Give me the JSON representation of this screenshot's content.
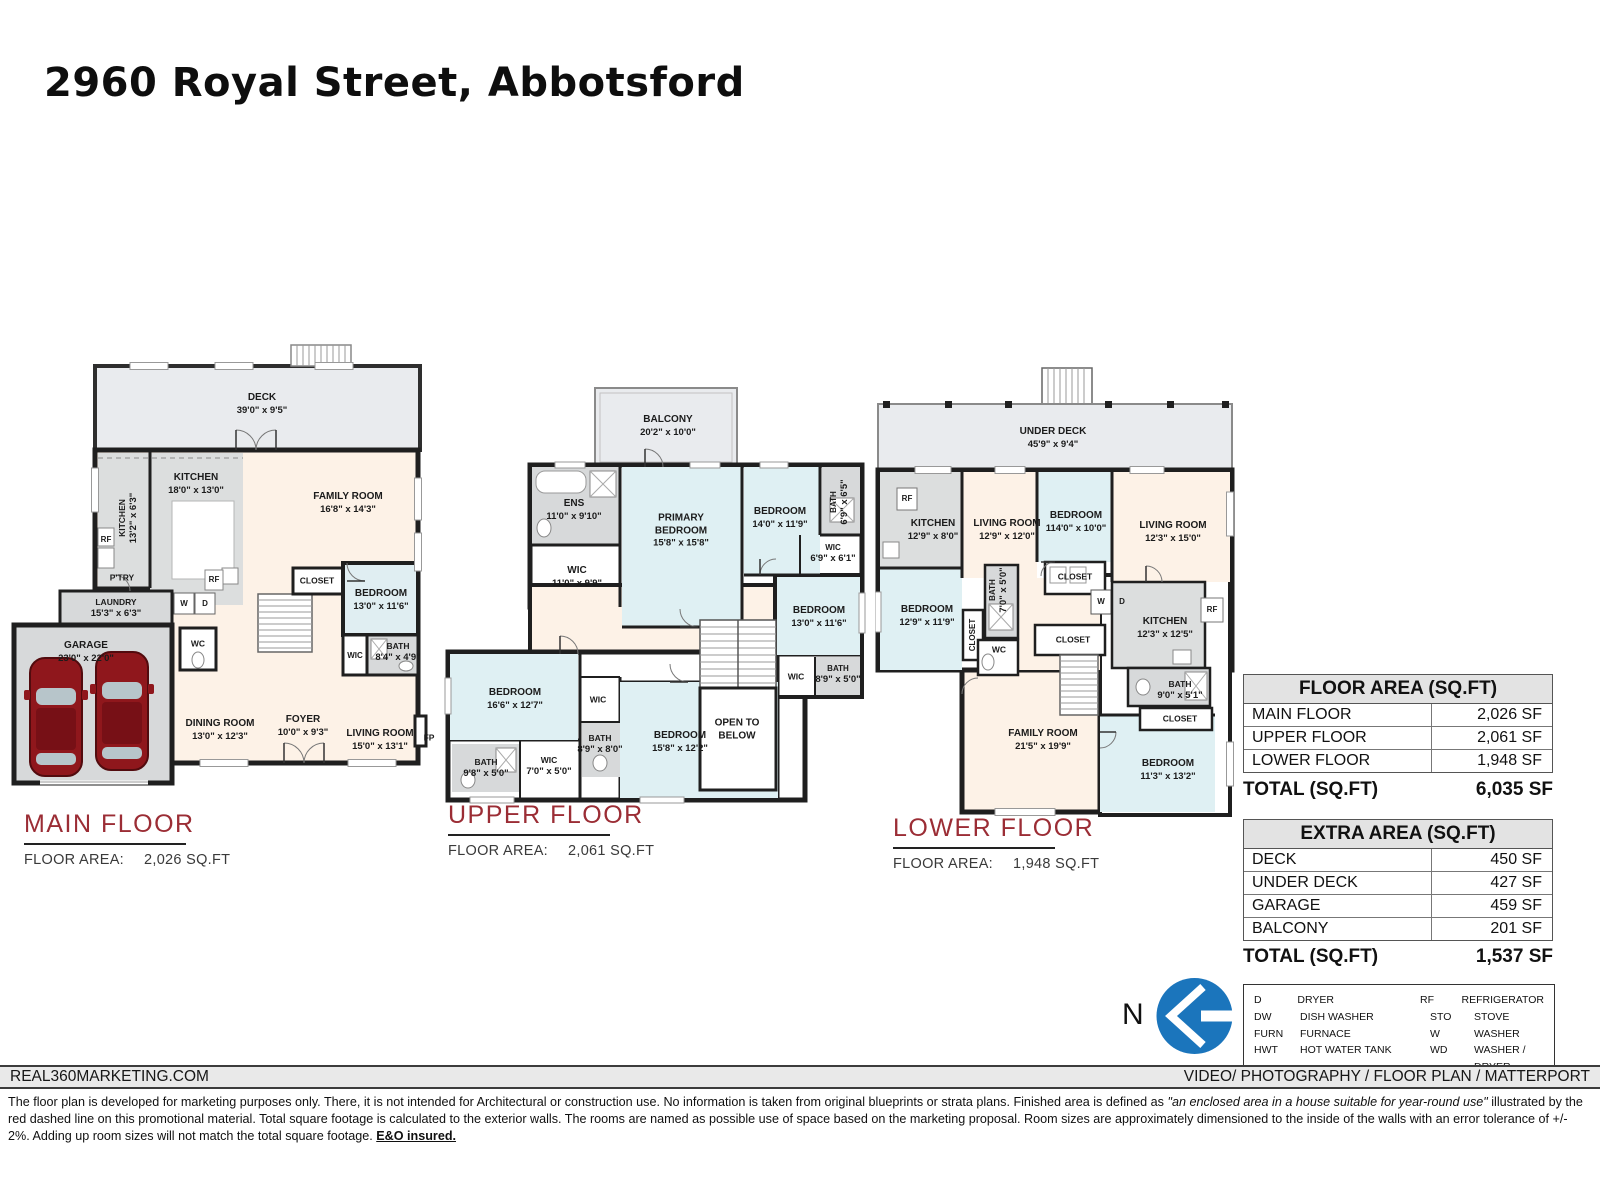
{
  "page": {
    "title": "2960 Royal Street, Abbotsford"
  },
  "floors": {
    "main": {
      "name": "MAIN FLOOR",
      "area_label": "FLOOR AREA:",
      "area_value": "2,026 SQ.FT",
      "labels": [
        {
          "name": "DECK",
          "dims": "39'0\" x 9'5\""
        },
        {
          "name": "KITCHEN",
          "dims": "18'0\" x 13'0\""
        },
        {
          "name": "KITCHEN",
          "dims": "13'2\" x 6'3\""
        },
        {
          "name": "RF",
          "dims": ""
        },
        {
          "name": "P'TRY",
          "dims": ""
        },
        {
          "name": "FAMILY ROOM",
          "dims": "16'8\" x 14'3\""
        },
        {
          "name": "RF",
          "dims": ""
        },
        {
          "name": "LAUNDRY",
          "dims": "15'3\" x 6'3\""
        },
        {
          "name": "W",
          "dims": ""
        },
        {
          "name": "D",
          "dims": ""
        },
        {
          "name": "GARAGE",
          "dims": "23'0\" x 22'0\""
        },
        {
          "name": "WC",
          "dims": ""
        },
        {
          "name": "CLOSET",
          "dims": ""
        },
        {
          "name": "BEDROOM",
          "dims": "13'0\" x 11'6\""
        },
        {
          "name": "WIC",
          "dims": ""
        },
        {
          "name": "BATH",
          "dims": "8'4\" x 4'9\""
        },
        {
          "name": "DINING ROOM",
          "dims": "13'0\" x 12'3\""
        },
        {
          "name": "FOYER",
          "dims": "10'0\" x 9'3\""
        },
        {
          "name": "LIVING ROOM",
          "dims": "15'0\" x 13'1\""
        },
        {
          "name": "FP",
          "dims": ""
        }
      ]
    },
    "upper": {
      "name": "UPPER FLOOR",
      "area_label": "FLOOR AREA:",
      "area_value": "2,061 SQ.FT",
      "labels": [
        {
          "name": "BALCONY",
          "dims": "20'2\" x 10'0\""
        },
        {
          "name": "ENS",
          "dims": "11'0\" x 9'10\""
        },
        {
          "name": "PRIMARY BEDROOM",
          "dims": "15'8\" x 15'8\""
        },
        {
          "name": "BEDROOM",
          "dims": "14'0\" x 11'9\""
        },
        {
          "name": "BATH",
          "dims": "6'9\" x 6'5\""
        },
        {
          "name": "WIC",
          "dims": "6'9\" x 6'1\""
        },
        {
          "name": "WIC",
          "dims": "11'0\" x 9'9\""
        },
        {
          "name": "BEDROOM",
          "dims": "13'0\" x 11'6\""
        },
        {
          "name": "BEDROOM",
          "dims": "16'6\" x 12'7\""
        },
        {
          "name": "WIC",
          "dims": ""
        },
        {
          "name": "BATH",
          "dims": "8'9\" x 8'0\""
        },
        {
          "name": "BEDROOM",
          "dims": "15'8\" x 12'2\""
        },
        {
          "name": "OPEN TO BELOW",
          "dims": ""
        },
        {
          "name": "WIC",
          "dims": ""
        },
        {
          "name": "BATH",
          "dims": "8'9\" x 5'0\""
        },
        {
          "name": "BATH",
          "dims": "9'8\" x 5'0\""
        },
        {
          "name": "WIC",
          "dims": "7'0\" x 5'0\""
        }
      ]
    },
    "lower": {
      "name": "LOWER FLOOR",
      "area_label": "FLOOR AREA:",
      "area_value": "1,948 SQ.FT",
      "labels": [
        {
          "name": "UNDER DECK",
          "dims": "45'9\" x 9'4\""
        },
        {
          "name": "RF",
          "dims": ""
        },
        {
          "name": "KITCHEN",
          "dims": "12'9\" x 8'0\""
        },
        {
          "name": "LIVING ROOM",
          "dims": "12'9\" x 12'0\""
        },
        {
          "name": "BEDROOM",
          "dims": "114'0\" x 10'0\""
        },
        {
          "name": "LIVING ROOM",
          "dims": "12'3\" x 15'0\""
        },
        {
          "name": "BEDROOM",
          "dims": "12'9\" x 11'9\""
        },
        {
          "name": "CLOSET",
          "dims": ""
        },
        {
          "name": "BATH",
          "dims": "7'0\" x 5'0\""
        },
        {
          "name": "WC",
          "dims": ""
        },
        {
          "name": "CLOSET",
          "dims": ""
        },
        {
          "name": "W",
          "dims": ""
        },
        {
          "name": "D",
          "dims": ""
        },
        {
          "name": "CLOSET",
          "dims": ""
        },
        {
          "name": "KITCHEN",
          "dims": "12'3\" x 12'5\""
        },
        {
          "name": "RF",
          "dims": ""
        },
        {
          "name": "BATH",
          "dims": "9'0\" x 5'1\""
        },
        {
          "name": "CLOSET",
          "dims": ""
        },
        {
          "name": "FAMILY ROOM",
          "dims": "21'5\" x 19'9\""
        },
        {
          "name": "BEDROOM",
          "dims": "11'3\" x 13'2\""
        }
      ]
    }
  },
  "floor_area_table": {
    "header": "FLOOR AREA (SQ.FT)",
    "rows": [
      {
        "label": "MAIN FLOOR",
        "value": "2,026 SF"
      },
      {
        "label": "UPPER FLOOR",
        "value": "2,061 SF"
      },
      {
        "label": "LOWER FLOOR",
        "value": "1,948 SF"
      }
    ],
    "total_label": "TOTAL (SQ.FT)",
    "total_value": "6,035 SF"
  },
  "extra_area_table": {
    "header": "EXTRA AREA (SQ.FT)",
    "rows": [
      {
        "label": "DECK",
        "value": "450 SF"
      },
      {
        "label": "UNDER DECK",
        "value": "427 SF"
      },
      {
        "label": "GARAGE",
        "value": "459 SF"
      },
      {
        "label": "BALCONY",
        "value": "201 SF"
      }
    ],
    "total_label": "TOTAL (SQ.FT)",
    "total_value": "1,537 SF"
  },
  "legend": {
    "rows": [
      {
        "a1": "D",
        "t1": "DRYER",
        "a2": "RF",
        "t2": "REFRIGERATOR"
      },
      {
        "a1": "DW",
        "t1": "DISH WASHER",
        "a2": "STO",
        "t2": "STOVE"
      },
      {
        "a1": "FURN",
        "t1": "FURNACE",
        "a2": "W",
        "t2": "WASHER"
      },
      {
        "a1": "HWT",
        "t1": "HOT WATER TANK",
        "a2": "WD",
        "t2": "WASHER / DRYER"
      }
    ]
  },
  "compass": {
    "label": "N"
  },
  "footer": {
    "left": "REAL360MARKETING.COM",
    "right": "VIDEO/ PHOTOGRAPHY / FLOOR PLAN / MATTERPORT",
    "disclaimer_1": "The floor plan is developed for marketing purposes only. There, it is not intended for Architectural or construction use. No information is  taken from original blueprints or strata plans. Finished area is defined as  ",
    "disclaimer_italic": "\"an enclosed area in a house suitable for year-round use\"",
    "disclaimer_2": " illustrated by the red dashed line on this promotional material. Total square footage is calculated to the exterior walls. The rooms are named as possible use of space based on the marketing proposal. Room sizes are approximately dimensioned to the inside of the walls with an error tolerance of +/- 2%. Adding up room sizes will not match the total square footage. ",
    "disclaimer_bold": "E&O insured."
  },
  "colors": {
    "accent_red": "#9b2d35",
    "compass_blue": "#1b75bc",
    "wall": "#1f1f1f",
    "room_cream": "#fdf2e7",
    "room_blue": "#dff0f3",
    "room_gray": "#d7d9da",
    "deck_gray": "#e9ebee"
  }
}
